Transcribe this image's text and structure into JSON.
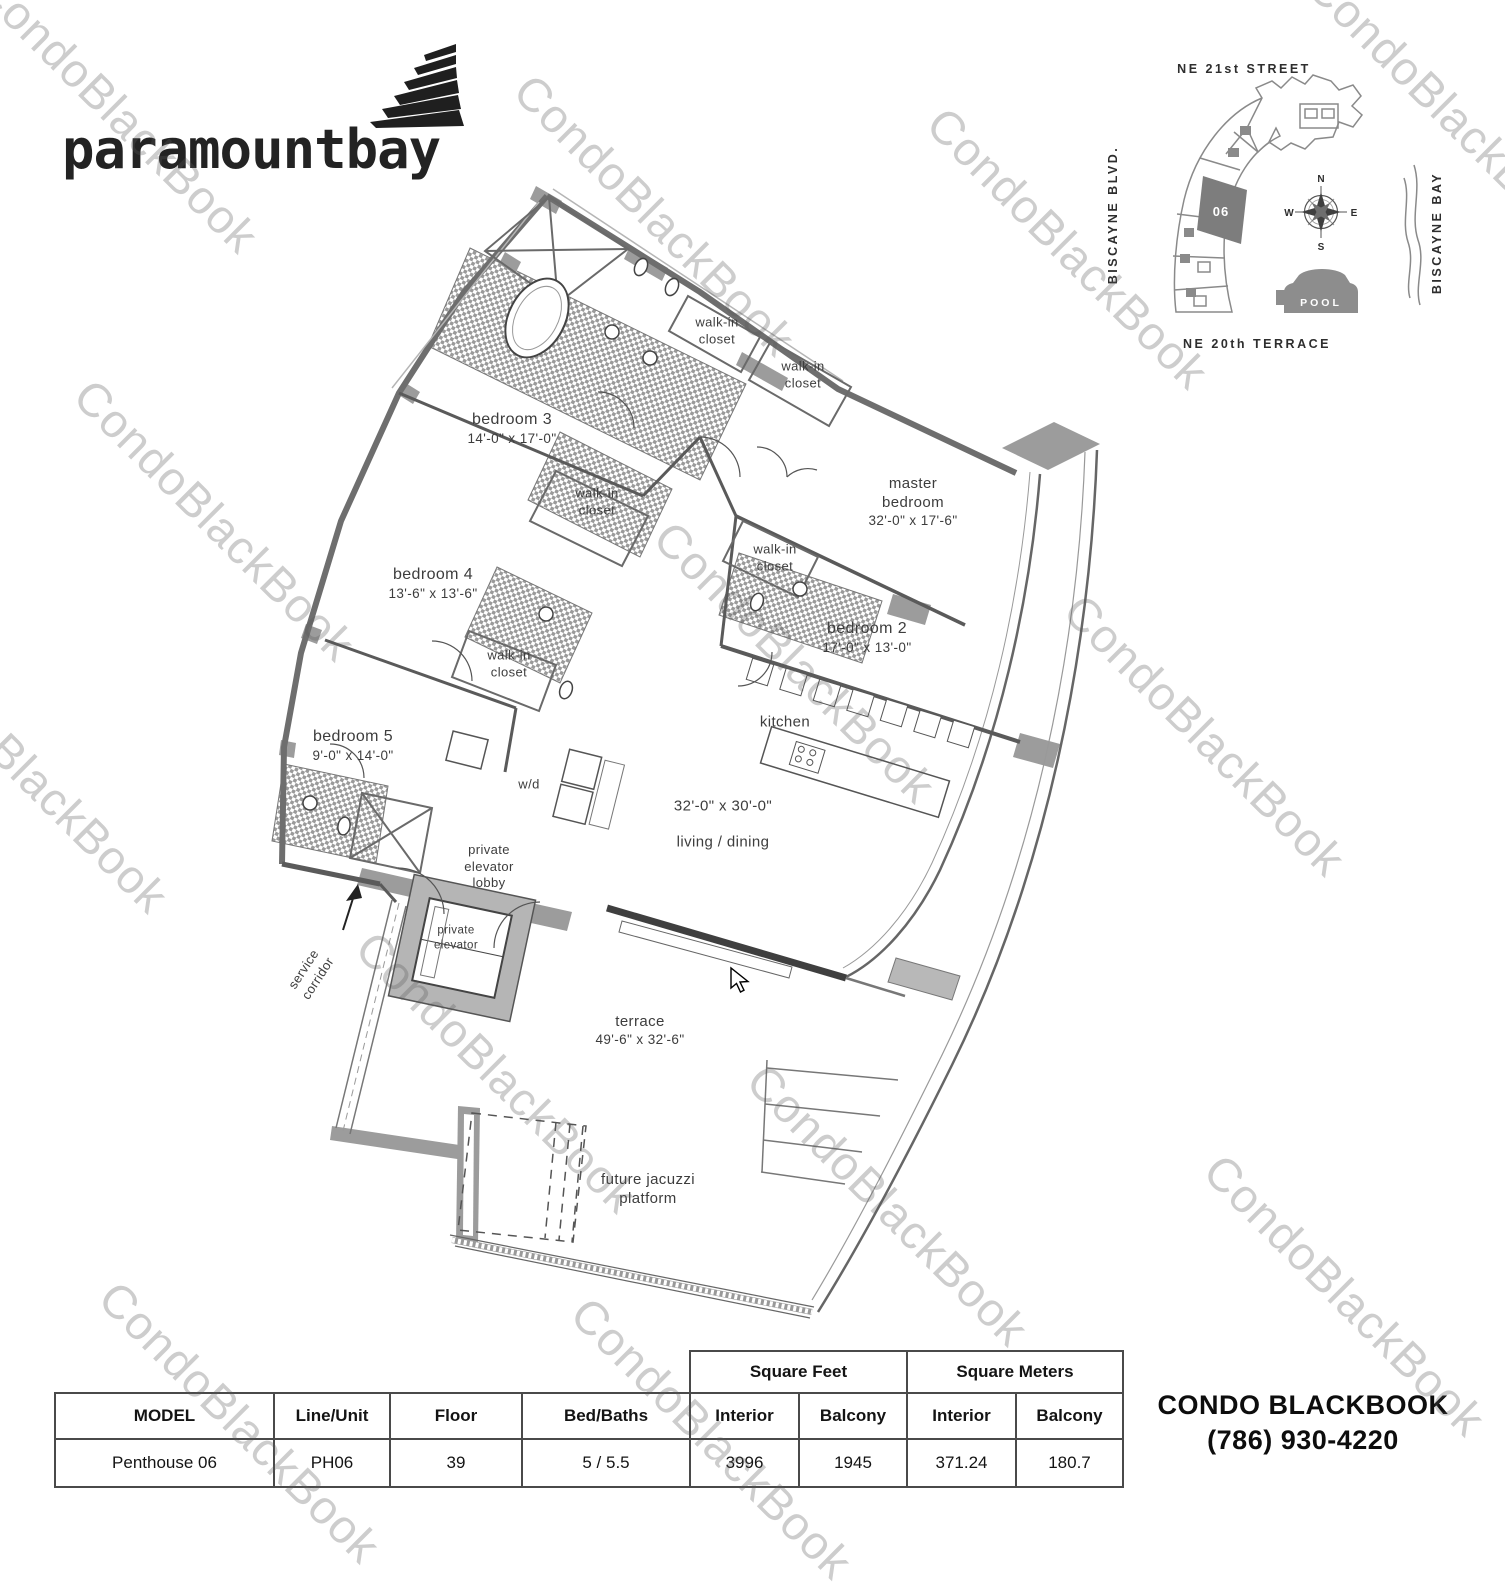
{
  "brand": {
    "logo_text": "paramountbay"
  },
  "watermark": {
    "text": "CondoBlackBook"
  },
  "sitemap": {
    "street_top": "NE 21st STREET",
    "street_left": "BISCAYNE BLVD.",
    "street_right": "BISCAYNE BAY",
    "street_bottom": "NE 20th TERRACE",
    "unit_number": "06",
    "pool_label": "POOL",
    "compass": {
      "n": "N",
      "e": "E",
      "s": "S",
      "w": "W"
    }
  },
  "plan": {
    "rooms": {
      "bedroom3": {
        "name": "bedroom 3",
        "dims": "14'-0\" x 17'-0\""
      },
      "master": {
        "line1": "master",
        "line2": "bedroom",
        "dims": "32'-0\" x 17'-6\""
      },
      "bedroom2": {
        "name": "bedroom 2",
        "dims": "17'-0\" x 13'-0\""
      },
      "bedroom4": {
        "name": "bedroom 4",
        "dims": "13'-6\" x 13'-6\""
      },
      "bedroom5": {
        "name": "bedroom 5",
        "dims": "9'-0\" x 14'-0\""
      },
      "kitchen": {
        "name": "kitchen"
      },
      "living": {
        "dims": "32'-0\" x 30'-0\"",
        "name": "living / dining"
      },
      "terrace": {
        "name": "terrace",
        "dims": "49'-6\" x 32'-6\""
      },
      "jacuzzi": {
        "line1": "future jacuzzi",
        "line2": "platform"
      },
      "walk_in": {
        "line1": "walk-in",
        "line2": "closet"
      },
      "wd": {
        "name": "w/d"
      },
      "elevator_lobby": {
        "line1": "private",
        "line2": "elevator",
        "line3": "lobby"
      },
      "private_elevator": {
        "line1": "private",
        "line2": "elevator"
      },
      "service_corridor": {
        "line1": "service",
        "line2": "corridor"
      }
    }
  },
  "table": {
    "group_headers": {
      "square_feet": "Square Feet",
      "square_meters": "Square Meters"
    },
    "columns": {
      "model": "MODEL",
      "line_unit": "Line/Unit",
      "floor": "Floor",
      "bed_baths": "Bed/Baths",
      "interior": "Interior",
      "balcony": "Balcony"
    },
    "row": {
      "model": "Penthouse 06",
      "line_unit": "PH06",
      "floor": "39",
      "bed_baths": "5 / 5.5",
      "sf_interior": "3996",
      "sf_balcony": "1945",
      "sm_interior": "371.24",
      "sm_balcony": "180.7"
    }
  },
  "footer": {
    "company": "CONDO BLACKBOOK",
    "phone": "(786) 930-4220"
  }
}
